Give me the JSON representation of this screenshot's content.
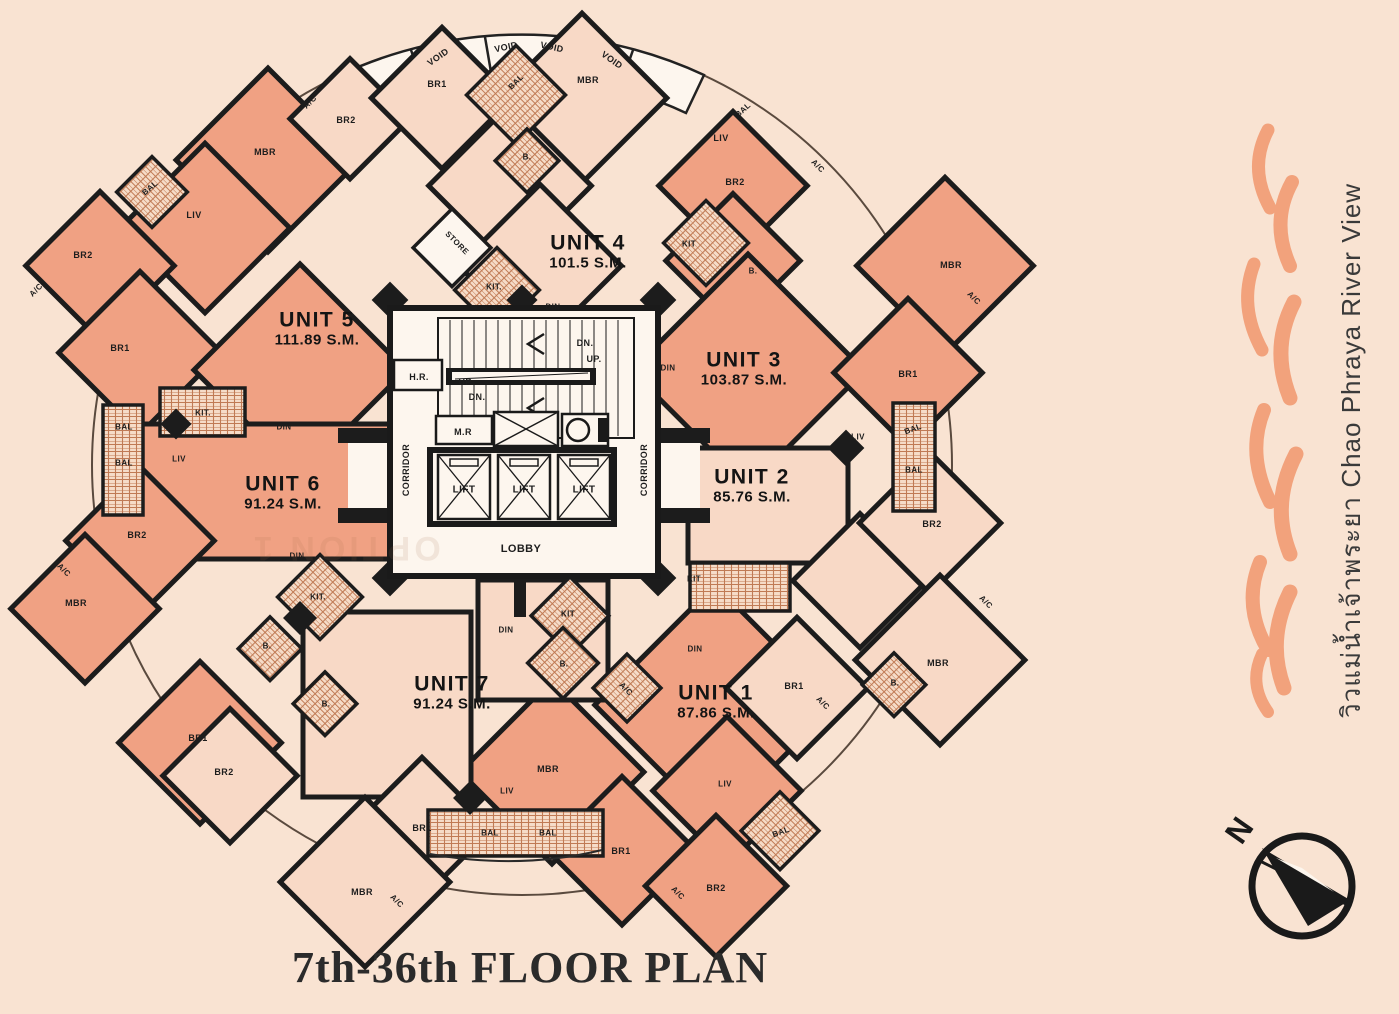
{
  "title": "7th-36th FLOOR PLAN",
  "side_caption": "วิวแม่น้ำเจ้าพระยา Chao Phraya River View",
  "watermark": "OPTION 1",
  "compass": {
    "north_label": "N"
  },
  "colors": {
    "background": "#f9e3d2",
    "unit_salmon": "#f0a183",
    "unit_light": "#f8d9c6",
    "wall": "#1c1c1c",
    "flame": "#f2a27c",
    "core_bg": "#fdf6ee"
  },
  "plan": {
    "units": [
      {
        "name": "UNIT 1",
        "area": "87.86 S.M.",
        "x": 716,
        "y": 702
      },
      {
        "name": "UNIT 2",
        "area": "85.76 S.M.",
        "x": 752,
        "y": 486
      },
      {
        "name": "UNIT 3",
        "area": "103.87 S.M.",
        "x": 744,
        "y": 369
      },
      {
        "name": "UNIT 4",
        "area": "101.5 S.M.",
        "x": 588,
        "y": 252
      },
      {
        "name": "UNIT 5",
        "area": "111.89 S.M.",
        "x": 317,
        "y": 329
      },
      {
        "name": "UNIT 6",
        "area": "91.24 S.M.",
        "x": 283,
        "y": 493
      },
      {
        "name": "UNIT 7",
        "area": "91.24 S.M.",
        "x": 452,
        "y": 693
      }
    ],
    "room_labels": [
      {
        "t": "VOID",
        "x": 438,
        "y": 57,
        "r": -35,
        "s": 9
      },
      {
        "t": "VOID",
        "x": 506,
        "y": 47,
        "r": -12,
        "s": 9
      },
      {
        "t": "VOID",
        "x": 552,
        "y": 47,
        "r": 12,
        "s": 9
      },
      {
        "t": "VOID",
        "x": 612,
        "y": 60,
        "r": 35,
        "s": 9
      },
      {
        "t": "BR1",
        "x": 437,
        "y": 84
      },
      {
        "t": "MBR",
        "x": 588,
        "y": 80
      },
      {
        "t": "BAL",
        "x": 516,
        "y": 82,
        "r": -45,
        "s": 8
      },
      {
        "t": "B.",
        "x": 527,
        "y": 157,
        "s": 8
      },
      {
        "t": "A/C",
        "x": 310,
        "y": 102,
        "r": -45,
        "s": 8
      },
      {
        "t": "BR2",
        "x": 346,
        "y": 120
      },
      {
        "t": "MBR",
        "x": 265,
        "y": 152
      },
      {
        "t": "BAL",
        "x": 150,
        "y": 188,
        "r": -40,
        "s": 8
      },
      {
        "t": "LIV",
        "x": 194,
        "y": 215
      },
      {
        "t": "BR2",
        "x": 83,
        "y": 255
      },
      {
        "t": "A/C",
        "x": 36,
        "y": 290,
        "r": -45,
        "s": 8
      },
      {
        "t": "BR1",
        "x": 120,
        "y": 348
      },
      {
        "t": "KIT.",
        "x": 203,
        "y": 413,
        "s": 8
      },
      {
        "t": "DIN",
        "x": 284,
        "y": 427,
        "s": 8
      },
      {
        "t": "STORE",
        "x": 457,
        "y": 243,
        "r": 45,
        "s": 8
      },
      {
        "t": "KIT.",
        "x": 494,
        "y": 287,
        "s": 8
      },
      {
        "t": "DIN",
        "x": 553,
        "y": 307,
        "s": 8
      },
      {
        "t": "BAL",
        "x": 743,
        "y": 110,
        "r": -42,
        "s": 8
      },
      {
        "t": "LIV",
        "x": 721,
        "y": 138
      },
      {
        "t": "A/C",
        "x": 818,
        "y": 166,
        "r": 45,
        "s": 8
      },
      {
        "t": "BR2",
        "x": 735,
        "y": 182
      },
      {
        "t": "KIT",
        "x": 689,
        "y": 244,
        "s": 8
      },
      {
        "t": "B.",
        "x": 753,
        "y": 271,
        "s": 8
      },
      {
        "t": "MBR",
        "x": 951,
        "y": 265
      },
      {
        "t": "A/C",
        "x": 974,
        "y": 298,
        "r": 45,
        "s": 8
      },
      {
        "t": "DIN",
        "x": 668,
        "y": 368,
        "s": 8
      },
      {
        "t": "BR1",
        "x": 908,
        "y": 374
      },
      {
        "t": "LIV",
        "x": 858,
        "y": 437,
        "s": 8
      },
      {
        "t": "BAL",
        "x": 913,
        "y": 429,
        "r": -20,
        "s": 8
      },
      {
        "t": "BAL",
        "x": 914,
        "y": 470,
        "s": 8
      },
      {
        "t": "BR2",
        "x": 932,
        "y": 524
      },
      {
        "t": "A/C",
        "x": 986,
        "y": 602,
        "r": 45,
        "s": 8
      },
      {
        "t": "MBR",
        "x": 938,
        "y": 663
      },
      {
        "t": "B.",
        "x": 895,
        "y": 683,
        "s": 8
      },
      {
        "t": "KIT",
        "x": 694,
        "y": 579,
        "s": 8
      },
      {
        "t": "DIN",
        "x": 695,
        "y": 649,
        "s": 8
      },
      {
        "t": "BR1",
        "x": 794,
        "y": 686
      },
      {
        "t": "A/C",
        "x": 823,
        "y": 703,
        "r": 45,
        "s": 8
      },
      {
        "t": "LIV",
        "x": 725,
        "y": 784,
        "s": 8
      },
      {
        "t": "BAL",
        "x": 781,
        "y": 832,
        "r": -20,
        "s": 8
      },
      {
        "t": "BR2",
        "x": 716,
        "y": 888
      },
      {
        "t": "A/C",
        "x": 678,
        "y": 893,
        "r": 45,
        "s": 8
      },
      {
        "t": "DIN",
        "x": 506,
        "y": 630,
        "s": 8
      },
      {
        "t": "KIT",
        "x": 568,
        "y": 614,
        "s": 8
      },
      {
        "t": "B.",
        "x": 564,
        "y": 664,
        "s": 8
      },
      {
        "t": "A/C",
        "x": 626,
        "y": 689,
        "r": 45,
        "s": 8
      },
      {
        "t": "MBR",
        "x": 548,
        "y": 769
      },
      {
        "t": "LIV",
        "x": 507,
        "y": 791,
        "s": 8
      },
      {
        "t": "BAL",
        "x": 490,
        "y": 833,
        "s": 8
      },
      {
        "t": "BAL",
        "x": 548,
        "y": 833,
        "s": 8
      },
      {
        "t": "BR1",
        "x": 621,
        "y": 851
      },
      {
        "t": "BR1",
        "x": 422,
        "y": 828
      },
      {
        "t": "MBR",
        "x": 362,
        "y": 892
      },
      {
        "t": "A/C",
        "x": 397,
        "y": 901,
        "r": 45,
        "s": 8
      },
      {
        "t": "LIV",
        "x": 179,
        "y": 459,
        "s": 8
      },
      {
        "t": "BR2",
        "x": 137,
        "y": 535
      },
      {
        "t": "MBR",
        "x": 76,
        "y": 603
      },
      {
        "t": "A/C",
        "x": 64,
        "y": 570,
        "r": 45,
        "s": 8
      },
      {
        "t": "B.",
        "x": 267,
        "y": 646,
        "s": 8
      },
      {
        "t": "B.",
        "x": 326,
        "y": 704,
        "s": 8
      },
      {
        "t": "BR1",
        "x": 198,
        "y": 738
      },
      {
        "t": "BR2",
        "x": 224,
        "y": 772
      },
      {
        "t": "KIT.",
        "x": 318,
        "y": 597,
        "s": 8
      },
      {
        "t": "DIN",
        "x": 297,
        "y": 556,
        "s": 8
      },
      {
        "t": "BAL",
        "x": 124,
        "y": 427,
        "s": 8
      },
      {
        "t": "BAL",
        "x": 124,
        "y": 463,
        "s": 8
      },
      {
        "t": "H.R.",
        "x": 419,
        "y": 377,
        "s": 9
      },
      {
        "t": "DN.",
        "x": 585,
        "y": 343,
        "s": 9
      },
      {
        "t": "UP.",
        "x": 594,
        "y": 359,
        "s": 9
      },
      {
        "t": "UP.",
        "x": 466,
        "y": 382,
        "s": 9
      },
      {
        "t": "DN.",
        "x": 477,
        "y": 397,
        "s": 9
      },
      {
        "t": "M.R",
        "x": 463,
        "y": 432,
        "s": 9
      },
      {
        "t": "LIFT",
        "x": 464,
        "y": 490,
        "s": 10
      },
      {
        "t": "LIFT",
        "x": 524,
        "y": 490,
        "s": 10
      },
      {
        "t": "LIFT",
        "x": 584,
        "y": 490,
        "s": 10
      },
      {
        "t": "LOBBY",
        "x": 521,
        "y": 549,
        "s": 11
      },
      {
        "t": "CORRIDOR",
        "x": 406,
        "y": 470,
        "r": -90,
        "s": 9
      },
      {
        "t": "CORRIDOR",
        "x": 644,
        "y": 470,
        "r": -90,
        "s": 9
      }
    ]
  }
}
